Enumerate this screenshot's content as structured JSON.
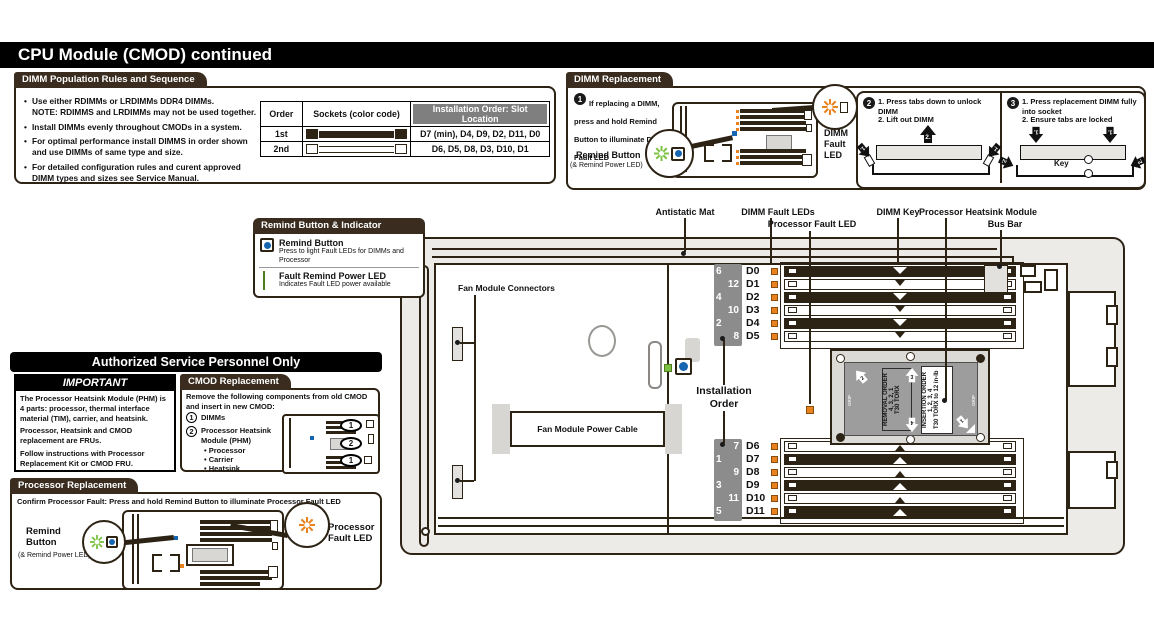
{
  "title": "CPU Module (CMOD) continued",
  "population_rules": {
    "header": "DIMM Population Rules and Sequence",
    "bullets": [
      "Use either RDIMMs or LRDIMMs DDR4 DIMMs.\nNOTE: RDIMMS and LRDIMMs may not be used together.",
      "Install DIMMs evenly throughout CMODs in a system.",
      "For optimal performance install DIMMS in order shown and use DIMMs of same type and size.",
      "For detailed configuration rules and curent approved DIMM types and sizes see Service Manual."
    ],
    "table": {
      "col_order": "Order",
      "col_sockets": "Sockets (color code)",
      "col_install": "Installation Order: Slot Location",
      "rows": [
        {
          "order": "1st",
          "slots": "D7 (min), D4, D9, D2, D11, D0"
        },
        {
          "order": "2nd",
          "slots": "D6, D5, D8, D3, D10, D1"
        }
      ]
    }
  },
  "dimm_replacement": {
    "header": "DIMM Replacement",
    "step1": {
      "num": "1",
      "text": "If replacing a DIMM, press and hold Remind Button to illuminate DIMM Fault LED",
      "remind_title": "Remind Button",
      "remind_sub": "(& Remind Power LED)",
      "fault_label": "DIMM\nFault\nLED"
    },
    "step2": {
      "num": "2",
      "line1": "1. Press tabs down to unlock DIMM",
      "line2": "2. Lift out DIMM",
      "arrow1": "1.",
      "arrow2": "2."
    },
    "step3": {
      "num": "3",
      "line1": "1. Press replacement DIMM fully into socket",
      "line2": "2. Ensure tabs are locked",
      "key_label": "Key",
      "arrow1": "1.",
      "arrow2": "2."
    }
  },
  "remind_indicator": {
    "header": "Remind Button & Indicator",
    "button_title": "Remind Button",
    "button_desc": "Press to light Fault LEDs for DIMMs and Processor",
    "led_title": "Fault Remind Power LED",
    "led_desc": "Indicates Fault LED power available"
  },
  "authorized": {
    "header": "Authorized Service Personnel Only",
    "important_title": "IMPORTANT",
    "p1": "The Processor Heatsink Module (PHM) is 4 parts: processor, thermal interface material (TIM), carrier, and heatsink.",
    "p2": "Processor, Heatsink and CMOD replacement are FRUs.",
    "p3": "Follow instructions with Processor Replacement Kit or CMOD FRU."
  },
  "cmod_replacement": {
    "header": "CMOD Replacement",
    "intro": "Remove the following components from old CMOD and insert in new CMOD:",
    "item1_num": "1",
    "item1": "DIMMs",
    "item2_num": "2",
    "item2": "Processor Heatsink Module (PHM)",
    "sub1": "• Processor",
    "sub2": "• Carrier",
    "sub3": "• Heatsink",
    "oval1": "1",
    "oval2": "2"
  },
  "processor_replacement": {
    "header": "Processor Replacement",
    "intro": "Confirm Processor Fault: Press and hold Remind Button to illuminate Processor Fault LED",
    "remind_title": "Remind\nButton",
    "remind_sub": "(& Remind Power LED)",
    "fault_label": "Processor\nFault LED"
  },
  "board": {
    "labels": {
      "antistatic": "Antistatic Mat",
      "fault_leds": "DIMM Fault LEDs",
      "proc_fault": "Processor Fault LED",
      "dimm_key": "DIMM Key",
      "phm": "Processor Heatsink Module",
      "bus_bar": "Bus Bar",
      "fan_conn": "Fan Module Connectors",
      "fan_cable": "Fan Module Power Cable",
      "install_order": "Installation\nOrder"
    },
    "top_bank": [
      {
        "order": "6",
        "slot": "D0"
      },
      {
        "order": "12",
        "slot": "D1"
      },
      {
        "order": "4",
        "slot": "D2"
      },
      {
        "order": "10",
        "slot": "D3"
      },
      {
        "order": "2",
        "slot": "D4"
      },
      {
        "order": "8",
        "slot": "D5"
      }
    ],
    "bottom_bank": [
      {
        "order": "7",
        "slot": "D6"
      },
      {
        "order": "1",
        "slot": "D7"
      },
      {
        "order": "9",
        "slot": "D8"
      },
      {
        "order": "3",
        "slot": "D9"
      },
      {
        "order": "11",
        "slot": "D10"
      },
      {
        "order": "5",
        "slot": "D11"
      }
    ],
    "phm": {
      "removal": "REMOVAL ORDER\n4, 3, 2, 1\nT30 TORX",
      "insertion": "INSERTION ORDER\n1, 2, 3, 4\nT30 TORX to 12 in-lb",
      "grip": "GRIP",
      "a1": "1",
      "a2": "2",
      "a3": "3",
      "a4": "4"
    }
  },
  "colors": {
    "accent_orange": "#e8821e",
    "led_green": "#7cc142",
    "button_blue": "#1565b0",
    "panel_brown": "#3a2d1f"
  }
}
